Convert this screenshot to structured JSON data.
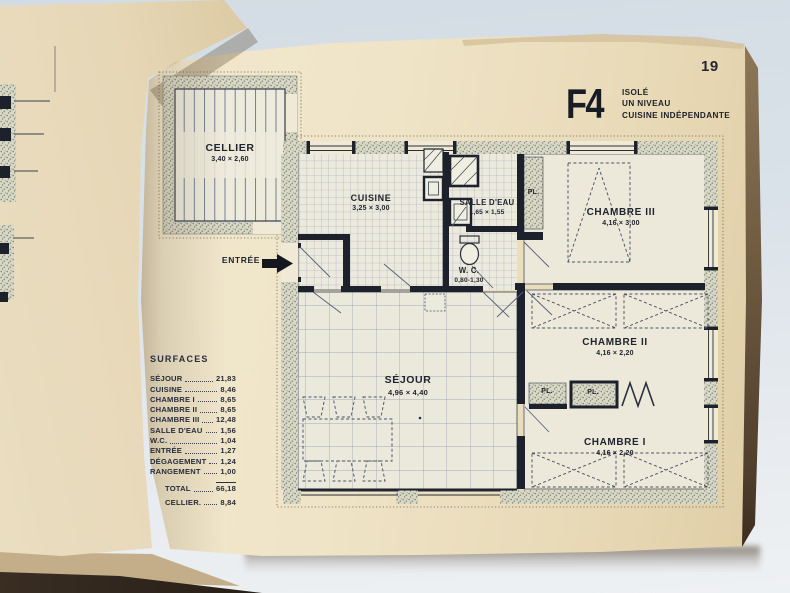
{
  "page": {
    "number": "19"
  },
  "title": {
    "code": "F4",
    "lines": [
      "ISOLÉ",
      "UN NIVEAU",
      "CUISINE INDÉPENDANTE"
    ]
  },
  "plan": {
    "entree_label": "ENTRÉE",
    "rooms": {
      "cellier": {
        "name": "CELLIER",
        "dims": "3,40 × 2,60"
      },
      "cuisine": {
        "name": "CUISINE",
        "dims": "3,25 × 3,00"
      },
      "salle_eau": {
        "name": "SALLE D'EAU",
        "dims": "1,65 × 1,55"
      },
      "wc": {
        "name": "W. C.",
        "dims": "0,80-1,30"
      },
      "chambre3": {
        "name": "CHAMBRE III",
        "dims": "4,16 × 3,00"
      },
      "chambre2": {
        "name": "CHAMBRE II",
        "dims": "4,16 × 2,20"
      },
      "chambre1": {
        "name": "CHAMBRE I",
        "dims": "4,16 × 2,20"
      },
      "sejour": {
        "name": "SÉJOUR",
        "dims": "4,96 × 4,40"
      }
    },
    "closets": {
      "pl_top": "PL.",
      "pl_a": "PL.",
      "pl_b": "PL."
    }
  },
  "surfaces": {
    "header": "SURFACES",
    "rows": [
      {
        "label": "SÉJOUR",
        "value": "21,83"
      },
      {
        "label": "CUISINE",
        "value": "8,46"
      },
      {
        "label": "CHAMBRE I",
        "value": "8,65"
      },
      {
        "label": "CHAMBRE II",
        "value": "8,65"
      },
      {
        "label": "CHAMBRE III",
        "value": "12,48"
      },
      {
        "label": "SALLE D'EAU",
        "value": "1,56"
      },
      {
        "label": "W.C.",
        "value": "1,04"
      },
      {
        "label": "ENTRÉE",
        "value": "1,27"
      },
      {
        "label": "DÉGAGEMENT",
        "value": "1,24"
      },
      {
        "label": "RANGEMENT",
        "value": "1,00"
      }
    ],
    "total": {
      "label": "TOTAL",
      "value": "66,18"
    },
    "cellier": {
      "label": "CELLIER.",
      "value": "8,84"
    }
  },
  "colors": {
    "paper": "#efe4c7",
    "ink": "#20242e",
    "stipple": "#7b8272",
    "background": "#dae2e9"
  }
}
